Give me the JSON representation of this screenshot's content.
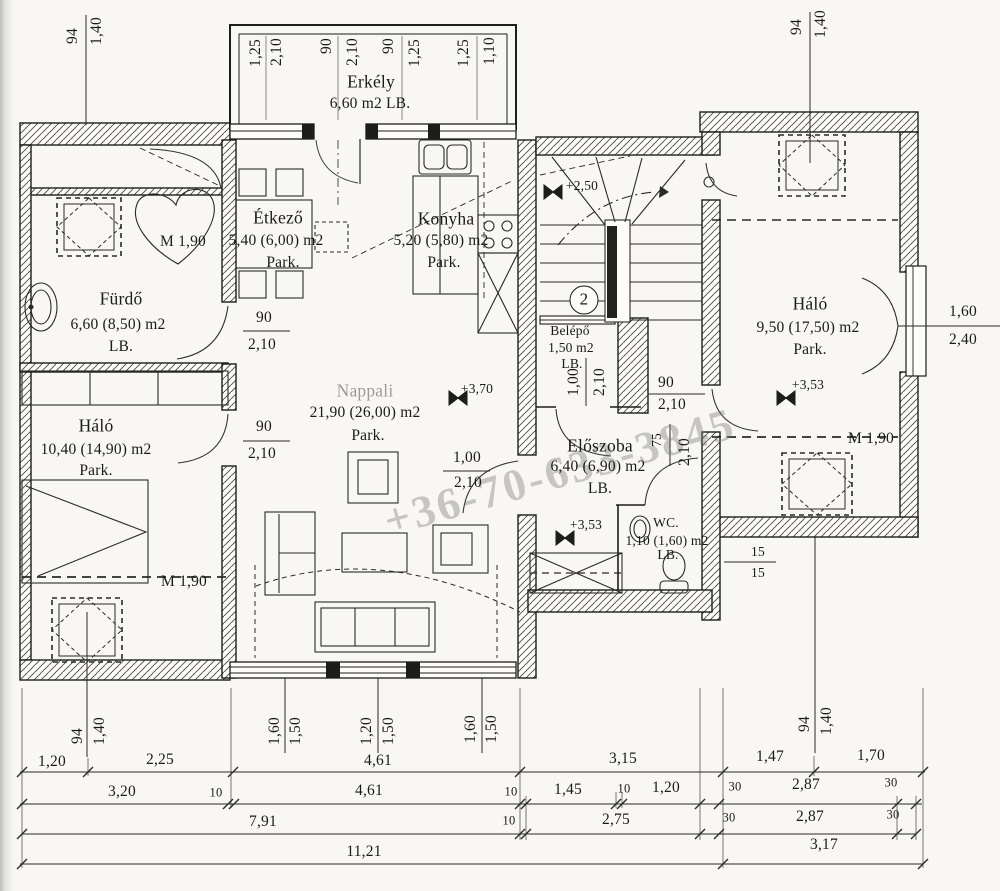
{
  "title": "Emeleti alaprajz (floor plan scan)",
  "watermark": {
    "text": "+36-70-633-3845"
  },
  "colors": {
    "ink": "#1a1a1a",
    "paper": "#f8f7f3",
    "watermark_gray": "#737373"
  },
  "rooms": [
    {
      "name": "Erkély",
      "area": "6,60 m2 LB."
    },
    {
      "name": "Étkező",
      "area": "5,40 (6,00) m2",
      "floor": "Park."
    },
    {
      "name": "Konyha",
      "area": "5,20 (5,80) m2",
      "floor": "Park."
    },
    {
      "name": "Fürdő",
      "area": "6,60 (8,50) m2",
      "floor": "LB."
    },
    {
      "name": "Háló",
      "area": "10,40 (14,90) m2",
      "floor": "Park."
    },
    {
      "name": "Nappali",
      "area": "21,90 (26,00) m2",
      "floor": "Park."
    },
    {
      "name": "Belépő",
      "area": "1,50 m2",
      "floor": "LB."
    },
    {
      "name": "Háló",
      "area": "9,50 (17,50) m2",
      "floor": "Park."
    },
    {
      "name": "Előszoba",
      "area": "6,40 (6,90) m2",
      "floor": "LB."
    },
    {
      "name": "WC.",
      "area": "1,10 (1,60) m2",
      "floor": "LB."
    }
  ],
  "texts": [
    {
      "id": "dim-top-94",
      "t": "94",
      "x": 73,
      "y": 36,
      "rot": -90
    },
    {
      "id": "dim-top-140",
      "t": "1,40",
      "x": 97,
      "y": 31,
      "rot": -90
    },
    {
      "id": "dim-top-125a",
      "t": "1,25",
      "x": 256,
      "y": 53,
      "rot": -90
    },
    {
      "id": "dim-top-210a",
      "t": "2,10",
      "x": 277,
      "y": 52,
      "rot": -90
    },
    {
      "id": "dim-top-90a",
      "t": "90",
      "x": 327,
      "y": 46,
      "rot": -90
    },
    {
      "id": "dim-top-210b",
      "t": "2,10",
      "x": 353,
      "y": 52,
      "rot": -90
    },
    {
      "id": "dim-top-90b",
      "t": "90",
      "x": 389,
      "y": 46,
      "rot": -90
    },
    {
      "id": "dim-top-125b",
      "t": "1,25",
      "x": 415,
      "y": 53,
      "rot": -90
    },
    {
      "id": "dim-top-125c",
      "t": "1,25",
      "x": 464,
      "y": 53,
      "rot": -90
    },
    {
      "id": "dim-top-110",
      "t": "1,10",
      "x": 490,
      "y": 51,
      "rot": -90
    },
    {
      "id": "dim-top-94r",
      "t": "94",
      "x": 797,
      "y": 27,
      "rot": -90
    },
    {
      "id": "dim-top-140r",
      "t": "1,40",
      "x": 821,
      "y": 24,
      "rot": -90
    },
    {
      "id": "room-erkely-name",
      "t": "Erkély",
      "x": 371,
      "y": 82,
      "cls": "lg"
    },
    {
      "id": "room-erkely-area",
      "t": "6,60 m2 LB.",
      "x": 370,
      "y": 104
    },
    {
      "id": "room-etkezo-name",
      "t": "Étkező",
      "x": 278,
      "y": 218,
      "cls": "lg"
    },
    {
      "id": "room-etkezo-area",
      "t": "5,40 (6,00) m2",
      "x": 276,
      "y": 241
    },
    {
      "id": "room-etkezo-floor",
      "t": "Park.",
      "x": 283,
      "y": 263
    },
    {
      "id": "room-konyha-name",
      "t": "Konyha",
      "x": 446,
      "y": 219,
      "cls": "lg"
    },
    {
      "id": "room-konyha-area",
      "t": "5,20 (5,80) m2",
      "x": 441,
      "y": 241
    },
    {
      "id": "room-konyha-floor",
      "t": "Park.",
      "x": 444,
      "y": 263
    },
    {
      "id": "room-furdo-name",
      "t": "Fürdő",
      "x": 121,
      "y": 299,
      "cls": "lg"
    },
    {
      "id": "room-furdo-area",
      "t": "6,60 (8,50) m2",
      "x": 118,
      "y": 325
    },
    {
      "id": "room-furdo-floor",
      "t": "LB.",
      "x": 121,
      "y": 347
    },
    {
      "id": "room-halo-left-name",
      "t": "Háló",
      "x": 96,
      "y": 426,
      "cls": "lg"
    },
    {
      "id": "room-halo-left-area",
      "t": "10,40 (14,90) m2",
      "x": 96,
      "y": 450
    },
    {
      "id": "room-halo-left-floor",
      "t": "Park.",
      "x": 96,
      "y": 471
    },
    {
      "id": "room-nappali-name",
      "t": "Nappali",
      "x": 365,
      "y": 391,
      "cls": "lg faint"
    },
    {
      "id": "room-nappali-area",
      "t": "21,90 (26,00) m2",
      "x": 365,
      "y": 413
    },
    {
      "id": "room-nappali-floor",
      "t": "Park.",
      "x": 368,
      "y": 436
    },
    {
      "id": "room-belepo-name",
      "t": "Belépő",
      "x": 570,
      "y": 331,
      "cls": "sm"
    },
    {
      "id": "room-belepo-area",
      "t": "1,50 m2",
      "x": 571,
      "y": 348,
      "cls": "sm"
    },
    {
      "id": "room-belepo-floor",
      "t": "LB.",
      "x": 572,
      "y": 364,
      "cls": "sm"
    },
    {
      "id": "room-halo-right-name",
      "t": "Háló",
      "x": 810,
      "y": 304,
      "cls": "lg"
    },
    {
      "id": "room-halo-right-area",
      "t": "9,50 (17,50) m2",
      "x": 808,
      "y": 328
    },
    {
      "id": "room-halo-right-floor",
      "t": "Park.",
      "x": 810,
      "y": 350
    },
    {
      "id": "room-eloszoba-name",
      "t": "Előszoba",
      "x": 600,
      "y": 446,
      "cls": "lg"
    },
    {
      "id": "room-eloszoba-area",
      "t": "6,40 (6,90) m2",
      "x": 598,
      "y": 467
    },
    {
      "id": "room-eloszoba-floor",
      "t": "LB.",
      "x": 600,
      "y": 489
    },
    {
      "id": "room-wc-name",
      "t": "WC.",
      "x": 666,
      "y": 523,
      "cls": "sm"
    },
    {
      "id": "room-wc-area",
      "t": "1,10 (1,60) m2",
      "x": 667,
      "y": 541,
      "cls": "sm"
    },
    {
      "id": "room-wc-floor",
      "t": "LB.",
      "x": 668,
      "y": 555,
      "cls": "sm"
    },
    {
      "id": "level-250",
      "t": "+2,50",
      "x": 582,
      "y": 186,
      "cls": "sm"
    },
    {
      "id": "level-370",
      "t": "+3,70",
      "x": 477,
      "y": 389,
      "cls": "sm"
    },
    {
      "id": "level-353-right",
      "t": "+3,53",
      "x": 808,
      "y": 385,
      "cls": "sm"
    },
    {
      "id": "level-353-center",
      "t": "+3,53",
      "x": 586,
      "y": 525,
      "cls": "sm"
    },
    {
      "id": "mline-furdo",
      "t": "M 1,90",
      "x": 183,
      "y": 242
    },
    {
      "id": "mline-halo-left",
      "t": "M 1,90",
      "x": 184,
      "y": 582
    },
    {
      "id": "mline-halo-right",
      "t": "M 1,90",
      "x": 871,
      "y": 439
    },
    {
      "id": "door-furdo-w",
      "t": "90",
      "x": 264,
      "y": 318
    },
    {
      "id": "door-furdo-h",
      "t": "2,10",
      "x": 262,
      "y": 345
    },
    {
      "id": "door-halol-w",
      "t": "90",
      "x": 264,
      "y": 427
    },
    {
      "id": "door-halol-h",
      "t": "2,10",
      "x": 262,
      "y": 454
    },
    {
      "id": "door-nappali-w",
      "t": "1,00",
      "x": 467,
      "y": 458
    },
    {
      "id": "door-nappali-h",
      "t": "2,10",
      "x": 468,
      "y": 483
    },
    {
      "id": "door-halor-w",
      "t": "90",
      "x": 666,
      "y": 383
    },
    {
      "id": "door-halor-h",
      "t": "2,10",
      "x": 672,
      "y": 405
    },
    {
      "id": "window-french-w",
      "t": "1,60",
      "x": 963,
      "y": 312
    },
    {
      "id": "window-french-h",
      "t": "2,40",
      "x": 963,
      "y": 340
    },
    {
      "id": "dim-15a",
      "t": "15",
      "x": 758,
      "y": 552,
      "cls": "sm"
    },
    {
      "id": "dim-15b",
      "t": "15",
      "x": 758,
      "y": 573,
      "cls": "sm"
    },
    {
      "id": "door-belepo-w",
      "t": "1,00",
      "x": 574,
      "y": 382,
      "rot": -90
    },
    {
      "id": "door-belepo-h",
      "t": "2,10",
      "x": 600,
      "y": 382,
      "rot": -90
    },
    {
      "id": "door-wc-w",
      "t": "75",
      "x": 657,
      "y": 440,
      "rot": -90,
      "cls": "sm"
    },
    {
      "id": "door-wc-h",
      "t": "2,10",
      "x": 685,
      "y": 452,
      "rot": -90
    },
    {
      "id": "dim-bot-94",
      "t": "94",
      "x": 78,
      "y": 736,
      "rot": -90
    },
    {
      "id": "dim-bot-140",
      "t": "1,40",
      "x": 100,
      "y": 731,
      "rot": -90
    },
    {
      "id": "dim-bot-160a",
      "t": "1,60",
      "x": 275,
      "y": 731,
      "rot": -90
    },
    {
      "id": "dim-bot-150a",
      "t": "1,50",
      "x": 296,
      "y": 731,
      "rot": -90
    },
    {
      "id": "dim-bot-120",
      "t": "1,20",
      "x": 367,
      "y": 731,
      "rot": -90
    },
    {
      "id": "dim-bot-150b",
      "t": "1,50",
      "x": 389,
      "y": 731,
      "rot": -90
    },
    {
      "id": "dim-bot-160b",
      "t": "1,60",
      "x": 471,
      "y": 729,
      "rot": -90
    },
    {
      "id": "dim-bot-150c",
      "t": "1,50",
      "x": 492,
      "y": 729,
      "rot": -90
    },
    {
      "id": "dim-bot-94r",
      "t": "94",
      "x": 805,
      "y": 724,
      "rot": -90
    },
    {
      "id": "dim-bot-140r",
      "t": "1,40",
      "x": 827,
      "y": 721,
      "rot": -90
    },
    {
      "id": "chain1-120",
      "t": "1,20",
      "x": 52,
      "y": 762
    },
    {
      "id": "chain1-225",
      "t": "2,25",
      "x": 160,
      "y": 760
    },
    {
      "id": "chain1-461",
      "t": "4,61",
      "x": 378,
      "y": 761
    },
    {
      "id": "chain1-315",
      "t": "3,15",
      "x": 623,
      "y": 759
    },
    {
      "id": "chain1-147",
      "t": "1,47",
      "x": 770,
      "y": 757
    },
    {
      "id": "chain1-170",
      "t": "1,70",
      "x": 871,
      "y": 756
    },
    {
      "id": "chain2-320",
      "t": "3,20",
      "x": 122,
      "y": 792
    },
    {
      "id": "chain2-10a",
      "t": "10",
      "x": 216,
      "y": 793,
      "cls": "xs"
    },
    {
      "id": "chain2-461",
      "t": "4,61",
      "x": 369,
      "y": 791
    },
    {
      "id": "chain2-10b",
      "t": "10",
      "x": 511,
      "y": 792,
      "cls": "xs"
    },
    {
      "id": "chain2-145",
      "t": "1,45",
      "x": 568,
      "y": 790
    },
    {
      "id": "chain2-10c",
      "t": "10",
      "x": 624,
      "y": 789,
      "cls": "xs"
    },
    {
      "id": "chain2-120",
      "t": "1,20",
      "x": 666,
      "y": 788
    },
    {
      "id": "chain2-30a",
      "t": "30",
      "x": 735,
      "y": 787,
      "cls": "xs"
    },
    {
      "id": "chain2-287",
      "t": "2,87",
      "x": 806,
      "y": 785
    },
    {
      "id": "chain2-30b",
      "t": "30",
      "x": 891,
      "y": 783,
      "cls": "xs"
    },
    {
      "id": "chain3-791",
      "t": "7,91",
      "x": 263,
      "y": 822
    },
    {
      "id": "chain3-10",
      "t": "10",
      "x": 509,
      "y": 821,
      "cls": "xs"
    },
    {
      "id": "chain3-275",
      "t": "2,75",
      "x": 616,
      "y": 820
    },
    {
      "id": "chain3-30a",
      "t": "30",
      "x": 729,
      "y": 818,
      "cls": "xs"
    },
    {
      "id": "chain3-287",
      "t": "2,87",
      "x": 810,
      "y": 817
    },
    {
      "id": "chain3-30b",
      "t": "30",
      "x": 893,
      "y": 815,
      "cls": "xs"
    },
    {
      "id": "chain4-1121",
      "t": "11,21",
      "x": 364,
      "y": 852
    },
    {
      "id": "chain4-317",
      "t": "3,17",
      "x": 824,
      "y": 845
    },
    {
      "id": "stair-number",
      "t": "2",
      "x": 584,
      "y": 300,
      "cls": "badge"
    }
  ]
}
